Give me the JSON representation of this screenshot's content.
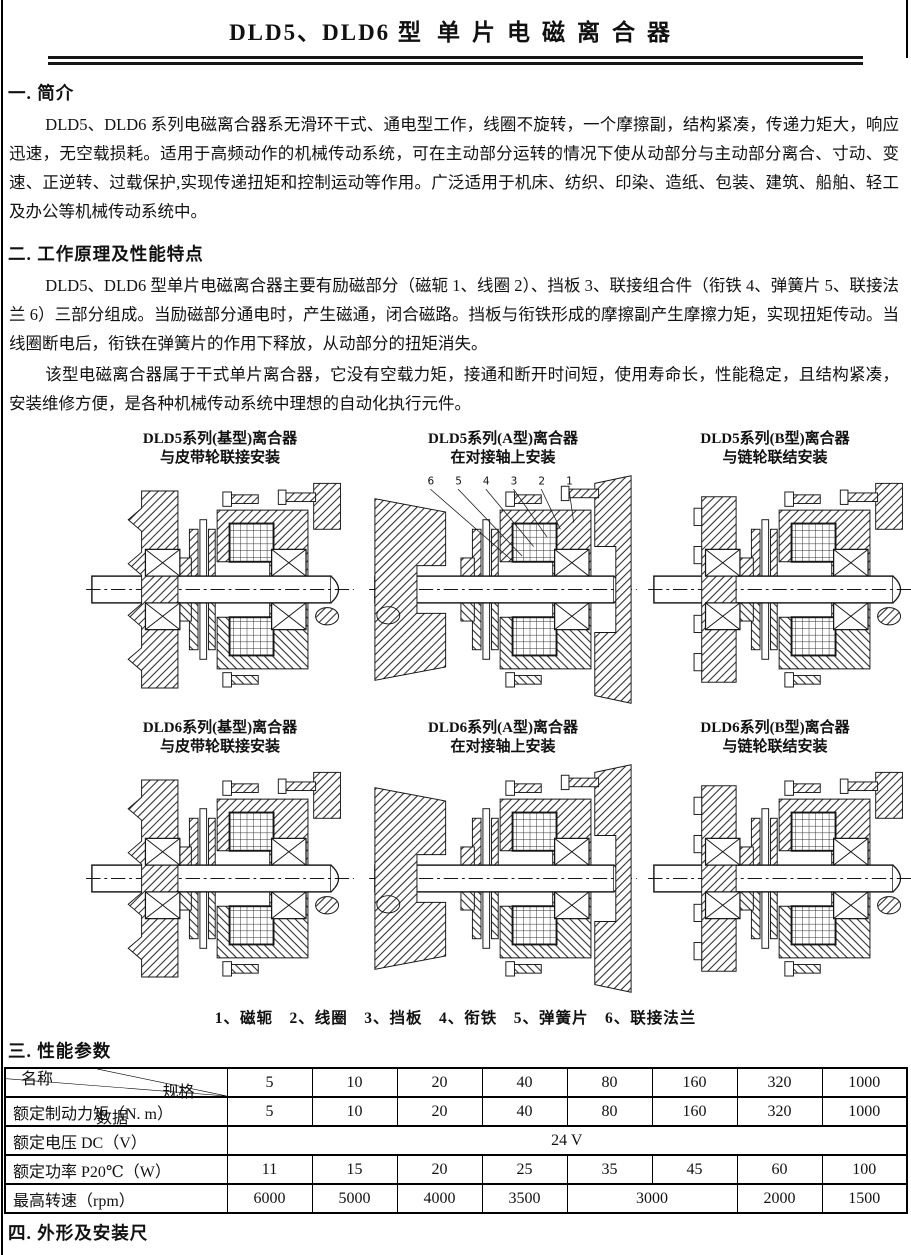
{
  "title": {
    "model": "DLD5、DLD6 型",
    "name": "单片电磁离合器"
  },
  "sections": {
    "intro": {
      "heading": "一. 简介",
      "body": "DLD5、DLD6 系列电磁离合器系无滑环干式、通电型工作，线圈不旋转，一个摩擦副，结构紧凑，传递力矩大，响应迅速，无空载损耗。适用于高频动作的机械传动系统，可在主动部分运转的情况下使从动部分与主动部分离合、寸动、变速、正逆转、过载保护,实现传递扭矩和控制运动等作用。广泛适用于机床、纺织、印染、造纸、包装、建筑、船舶、轻工及办公等机械传动系统中。"
    },
    "principle": {
      "heading": "二. 工作原理及性能特点",
      "body1": "DLD5、DLD6 型单片电磁离合器主要有励磁部分（磁轭 1、线圈 2）、挡板 3、联接组合件（衔铁 4、弹簧片 5、联接法兰 6）三部分组成。当励磁部分通电时，产生磁通，闭合磁路。挡板与衔铁形成的摩擦副产生摩擦力矩，实现扭矩传动。当线圈断电后，衔铁在弹簧片的作用下释放，从动部分的扭矩消失。",
      "body2": "该型电磁离合器属于干式单片离合器，它没有空载力矩，接通和断开时间短，使用寿命长，性能稳定，且结构紧凑，安装维修方便，是各种机械传动系统中理想的自动化执行元件。"
    },
    "params": {
      "heading": "三. 性能参数"
    },
    "dims": {
      "heading": "四. 外形及安装尺"
    }
  },
  "figures": {
    "items": [
      {
        "line1": "DLD5系列(基型)离合器",
        "line2": "与皮带轮联接安装"
      },
      {
        "line1": "DLD5系列(A型)离合器",
        "line2": "在对接轴上安装"
      },
      {
        "line1": "DLD5系列(B型)离合器",
        "line2": "与链轮联结安装"
      },
      {
        "line1": "DLD6系列(基型)离合器",
        "line2": "与皮带轮联接安装"
      },
      {
        "line1": "DLD6系列(A型)离合器",
        "line2": "在对接轴上安装"
      },
      {
        "line1": "DLD6系列(B型)离合器",
        "line2": "与链轮联结安装"
      }
    ],
    "part_numbers": [
      "6",
      "5",
      "4",
      "3",
      "2",
      "1"
    ],
    "legend": "1、磁轭　2、线圈　3、挡板　4、衔铁　5、弹簧片　6、联接法兰"
  },
  "table": {
    "corner": {
      "spec": "规格",
      "data": "数据",
      "name": "名称"
    },
    "spec_columns": [
      "5",
      "10",
      "20",
      "40",
      "80",
      "160",
      "320",
      "1000"
    ],
    "rows": [
      {
        "label": "额定制动力矩（N. m）",
        "values": [
          "5",
          "10",
          "20",
          "40",
          "80",
          "160",
          "320",
          "1000"
        ]
      },
      {
        "label": "额定电压 DC（V）",
        "merged": "24 V"
      },
      {
        "label": "额定功率 P20℃（W）",
        "values": [
          "11",
          "15",
          "20",
          "25",
          "35",
          "45",
          "60",
          "100"
        ]
      },
      {
        "label": "最高转速（rpm）",
        "values": [
          "6000",
          "5000",
          "4000",
          "3500",
          "3000",
          "2000",
          "1500"
        ]
      }
    ]
  }
}
